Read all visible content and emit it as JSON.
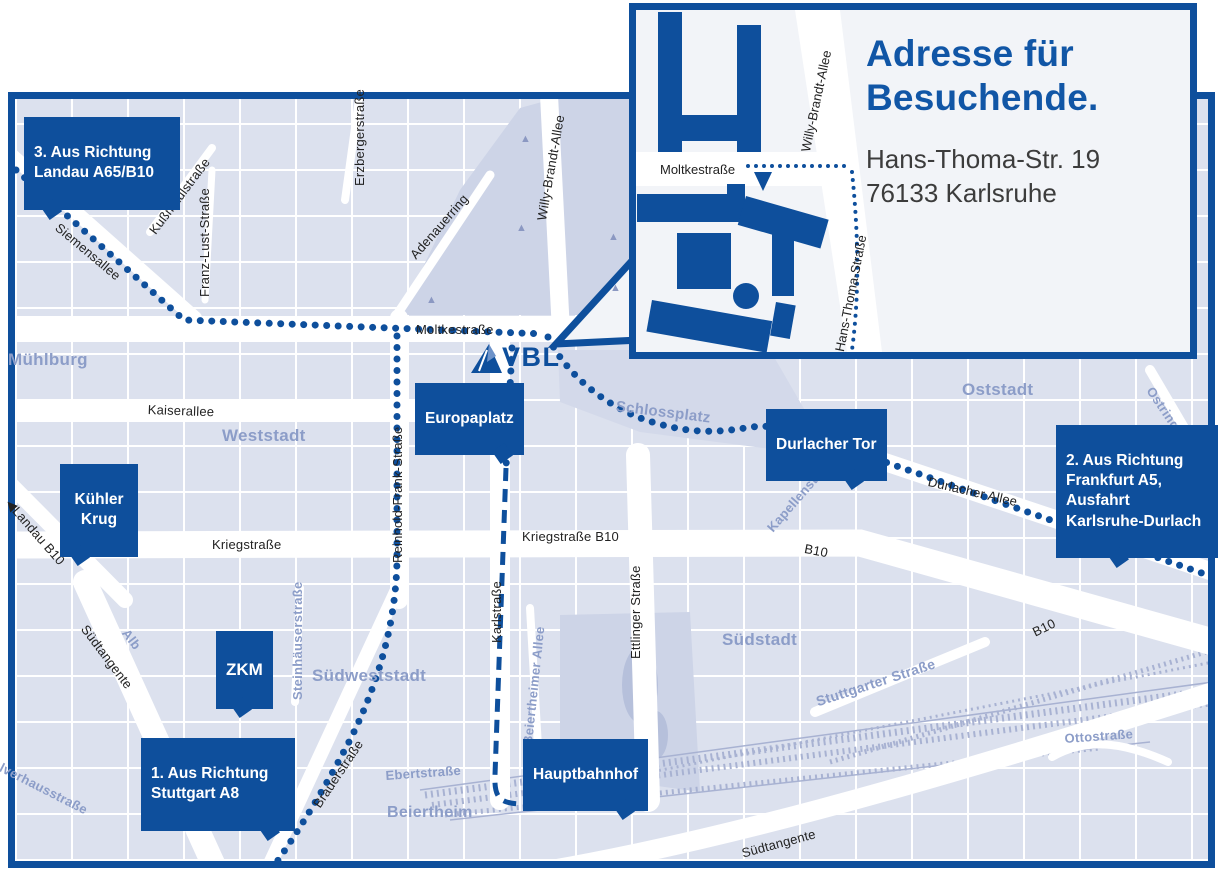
{
  "inset": {
    "title": "Adresse für\nBesuchende.",
    "address": "Hans-Thoma-Str. 19\n76133 Karlsruhe",
    "streets": {
      "moltkestrasse": "Moltkestraße",
      "willy_brandt_allee": "Willy-Brandt-Allee",
      "hans_thoma_strasse": "Hans-Thoma-Straße"
    }
  },
  "logo": {
    "text": "VBL"
  },
  "route_badges": {
    "route1": "1. Aus Richtung\nStuttgart A8",
    "route2": "2. Aus Richtung\nFrankfurt A5,\nAusfahrt\nKarlsruhe-Durlach",
    "route3": "3. Aus Richtung\nLandau A65/B10"
  },
  "poi_badges": {
    "europaplatz": "Europaplatz",
    "durlacher_tor": "Durlacher Tor",
    "hauptbahnhof": "Hauptbahnhof",
    "zkm": "ZKM",
    "kuehler_krug": "Kühler\nKrug"
  },
  "streets": {
    "siemensallee": "Siemensallee",
    "kussmaulstrasse": "Kußmaulstraße",
    "franz_lust_strasse": "Franz-Lust-Straße",
    "erzbergerstrasse": "Erzbergerstraße",
    "adenauerring": "Adenauerring",
    "willy_brandt_allee": "Willy-Brandt-Allee",
    "moltkestrasse": "Moltkestraße",
    "kaiserallee": "Kaiserallee",
    "kriegstrasse": "Kriegstraße",
    "kriegstrasse_b10": "Kriegstraße B10",
    "reinhold_frank_strasse": "Reinhold-Frank-Straße",
    "karlstrasse": "Karlstraße",
    "ettlinger_strasse": "Ettlinger Straße",
    "durlacher_allee": "Durlacher Allee",
    "b10_east": "B10",
    "b10_south": "B10",
    "landau_b10": "◀Landau B10",
    "brauerstrasse": "Brauerstraße",
    "suedtangente_west": "Südtangente",
    "suedtangente_sued": "Südtangente"
  },
  "districts": {
    "muehlburg": "Mühlburg",
    "weststadt": "Weststadt",
    "oststadt": "Oststadt",
    "suedstadt": "Südstadt",
    "suedweststadt": "Südweststadt",
    "beiertheim": "Beiertheim",
    "schlossplatz": "Schlossplatz",
    "ebertstrasse": "Ebertstraße",
    "beiertheimer_allee": "Beiertheimer Allee",
    "steinhaeuserstrasse": "Steinhäuserstraße",
    "alb": "Alb",
    "stuttgarter_strasse": "Stuttgarter Straße",
    "ottostrasse": "Ottostraße",
    "ostring": "Ostring",
    "kapellenstrasse": "Kapellenstraße",
    "pulverhausstrasse": "lverhausstraße"
  },
  "icons": {
    "tree_icon": "▲"
  },
  "colors": {
    "accent": "#0e4f9c",
    "title_blue": "#1156a6",
    "light_label": "#8c9dc8",
    "map_block": "#dce1ee"
  }
}
